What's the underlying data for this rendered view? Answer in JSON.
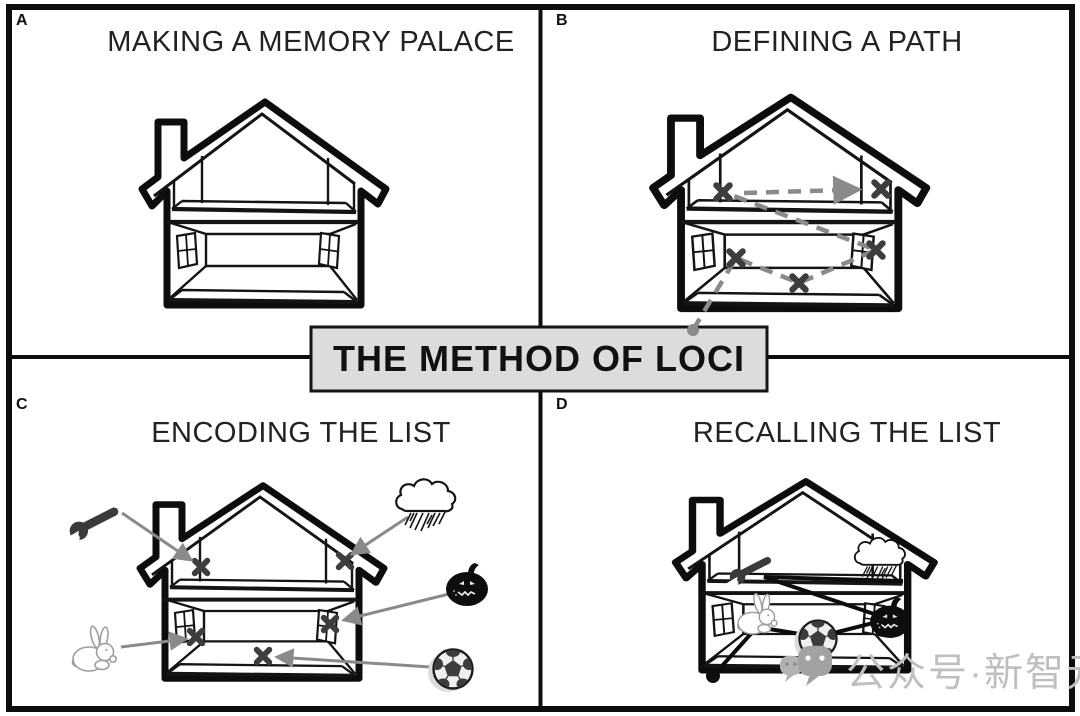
{
  "figure": {
    "center_label": "THE METHOD OF LOCI",
    "panels": [
      {
        "id": "A",
        "title": "MAKING A MEMORY PALACE",
        "icons": [
          "memory-palace-house-icon"
        ]
      },
      {
        "id": "B",
        "title": "DEFINING A PATH",
        "icons": [
          "memory-palace-house-icon",
          "location-x-mark-icon",
          "dashed-route-icon",
          "route-start-dot-icon"
        ]
      },
      {
        "id": "C",
        "title": "ENCODING THE LIST",
        "icons": [
          "memory-palace-house-icon",
          "location-x-mark-icon",
          "wrench-icon",
          "storm-cloud-icon",
          "pumpkin-icon",
          "rabbit-icon",
          "soccer-ball-icon"
        ]
      },
      {
        "id": "D",
        "title": "RECALLING THE LIST",
        "icons": [
          "memory-palace-house-icon",
          "solid-route-icon",
          "wrench-icon",
          "storm-cloud-icon",
          "rabbit-icon",
          "soccer-ball-icon",
          "pumpkin-icon"
        ]
      }
    ],
    "watermark": {
      "icon": "wechat-official-account-icon",
      "text": "公众号·新智元"
    },
    "colors": {
      "ink": "#111111",
      "route_gray": "#8a8a8a",
      "box_bg": "#dcdcdc",
      "watermark_gray": "#bfbfbf"
    }
  }
}
